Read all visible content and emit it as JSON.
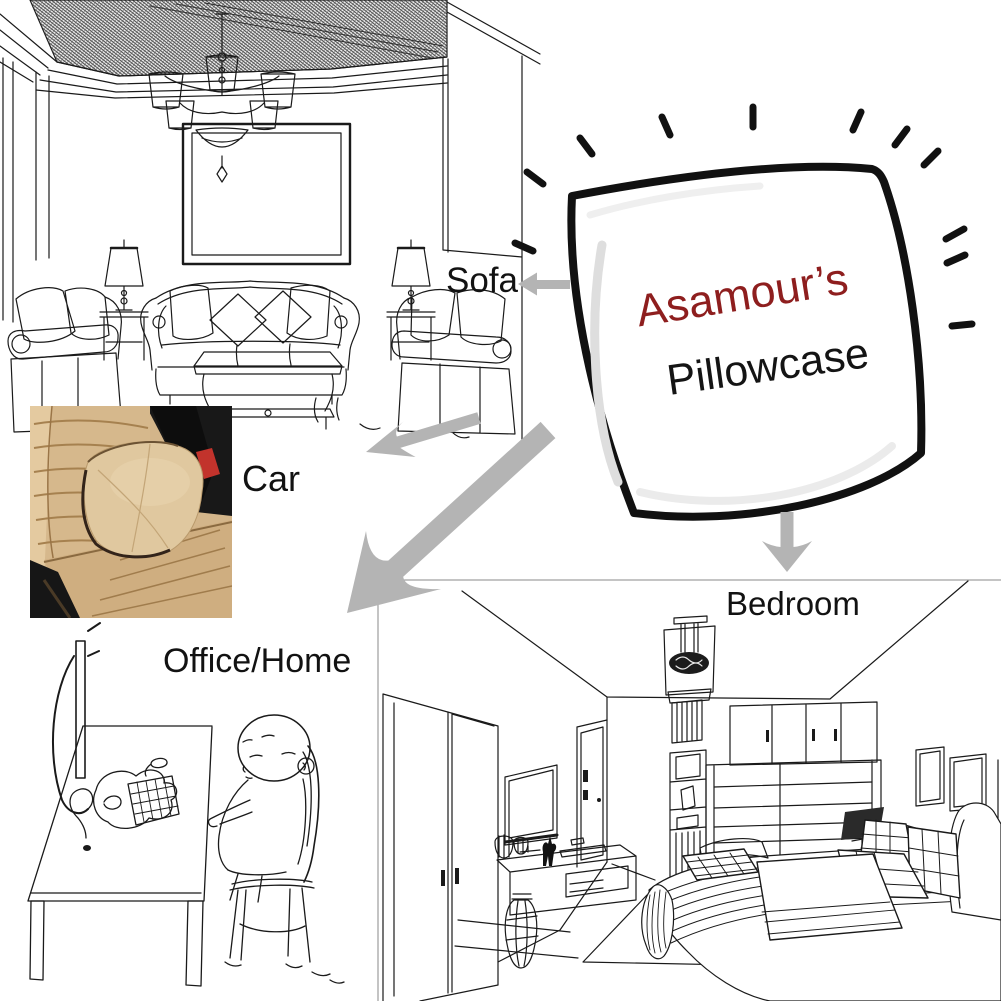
{
  "image": {
    "kind": "product usage infographic",
    "background": "#ffffff",
    "line_color": "#1a1a1a",
    "arrow_color": "#b4b4b4"
  },
  "product": {
    "brand": "Asamour’s",
    "name": "Pillowcase",
    "brand_color": "#8e1e1e",
    "name_color": "#141414"
  },
  "usage_labels": {
    "sofa": "Sofa",
    "car": "Car",
    "office": "Office/Home",
    "bedroom": "Bedroom"
  },
  "scenes": [
    {
      "id": "living-room",
      "position": "top-left",
      "style": "line drawing"
    },
    {
      "id": "car-seat",
      "position": "middle-left",
      "style": "photo"
    },
    {
      "id": "office-desk",
      "position": "bottom-left",
      "style": "cartoon line drawing"
    },
    {
      "id": "bedroom",
      "position": "bottom-right",
      "style": "line drawing"
    }
  ],
  "car_photo_colors": {
    "seat": "#d2b186",
    "cushion": "#e0c89f",
    "console": "#161616",
    "seatbelt_release": "#c2332c"
  }
}
